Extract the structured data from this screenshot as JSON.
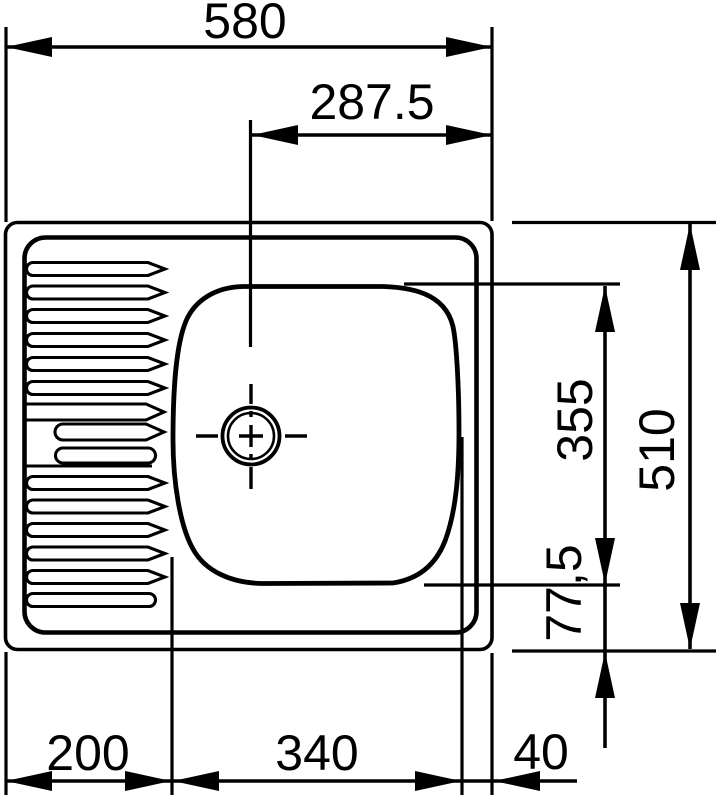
{
  "page": {
    "background": "#ffffff",
    "ink": "#000000"
  },
  "drawing": {
    "kind": "sink-top-view-dimension-drawing",
    "dims": {
      "overall_width": "580",
      "drain_center_from_right_edge": "287.5",
      "bowl_length": "355",
      "overall_depth": "510",
      "bowl_to_front_edge": "77,5",
      "drainer_width": "200",
      "bowl_width": "340",
      "bowl_to_right_edge": "40"
    }
  }
}
